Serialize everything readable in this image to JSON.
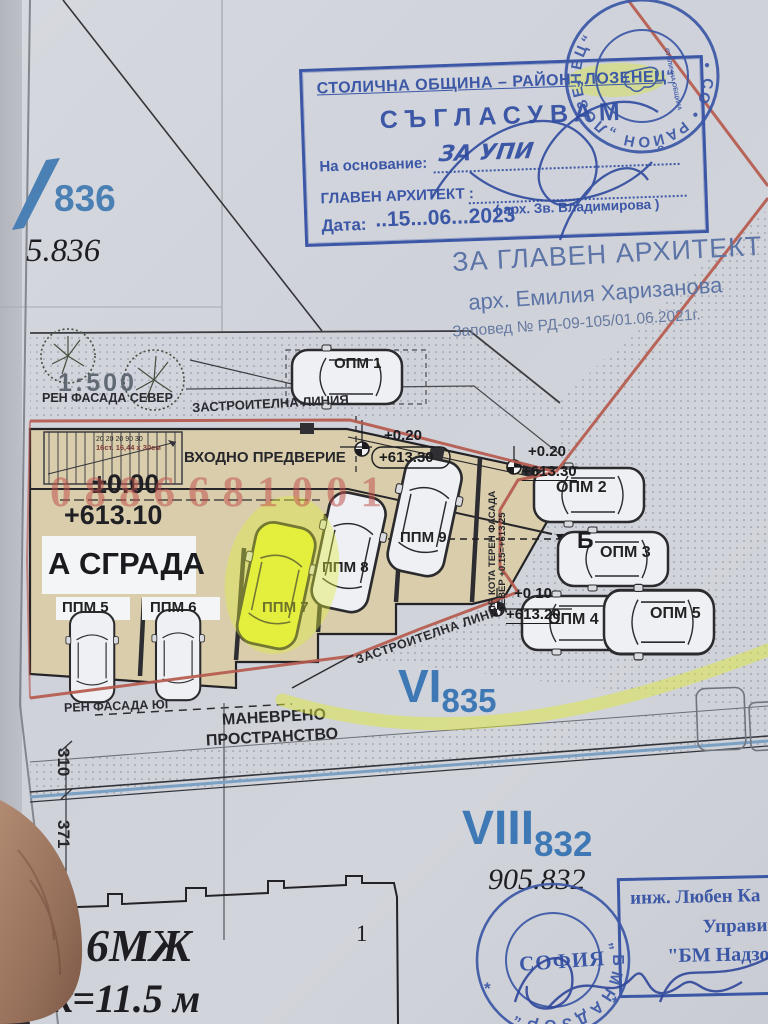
{
  "colors": {
    "stamp_blue": "#3b57a6",
    "plot_blue": "#3f79b5",
    "plan_red": "#b65a4e",
    "highlight_yellow": "#dde84a",
    "building_tan": "#d9cdab",
    "watermark_red": "#c04e48"
  },
  "left_margin": {
    "plot_label": "836",
    "plot_value": "5.836"
  },
  "approval_stamp": {
    "org": "СТОЛИЧНА ОБЩИНА – РАЙОН „ЛОЗЕНЕЦ“",
    "action": "СЪГЛАСУВАМ",
    "basis_label": "На основание:",
    "basis_value": "ЗА УПИ",
    "architect_label": "ГЛАВЕН АРХИТЕКТ :",
    "architect_name": "( арх. Зв. Владимирова )",
    "date_label": "Дата:",
    "date_value": "..15...06...2023"
  },
  "round_stamp_top": {
    "ring": "• СО • РАЙОН „ЛОЗЕНЕЦ“",
    "center": "СТОЛИЧНА ОБЩИНА"
  },
  "approval_note": {
    "title": "ЗА ГЛАВЕН АРХИТЕКТ",
    "name": "арх. Емилия Харизанова",
    "order": "Заповед № РД-09-105/01.06.2021г."
  },
  "watermark": "0886681001",
  "plan": {
    "scale": "1:500",
    "facade_north": "РЕН ФАСАДА СЕВЕР",
    "building_line": "ЗАСТРОИТЕЛНА ЛИНИЯ",
    "building_line_diag": "ЗАСТРОИТЕЛНА ЛИНИЯ",
    "entry_hall": "ВХОДНО ПРЕДВЕРИЕ",
    "stairs_dims": "20 20 20   90   30",
    "stairs_note": "16ст. 16,44 х 30см",
    "level_zero": "±0.00",
    "elev_zero": "+613.10",
    "level_020": "+0.20",
    "elev_020": "+613.30",
    "level_010": "+0.10",
    "elev_010": "+613.20",
    "building_label": "А СГРАДА",
    "marker_b": "Б",
    "kota_note_1": "ПР. КОТА ТЕРЕН ФАСАДА",
    "kota_note_2": "СЕВЕР +0.15=+613.25",
    "maneuver_1": "МАНЕВРЕНО",
    "maneuver_2": "ПРОСТРАНСТВО",
    "facade_south": "РЕН ФАСАДА ЮГ",
    "spots": [
      {
        "label": "ОПМ 1"
      },
      {
        "label": "ОПМ 2"
      },
      {
        "label": "ОПМ 3"
      },
      {
        "label": "ОПМ 4"
      },
      {
        "label": "ОПМ 5"
      },
      {
        "label": "ППМ 5"
      },
      {
        "label": "ППМ 6"
      },
      {
        "label": "ППМ 7"
      },
      {
        "label": "ППМ 8"
      },
      {
        "label": "ППМ 9"
      }
    ],
    "plot_vi": "VI",
    "plot_vi_num": "835",
    "dim_310": "310",
    "dim_371": "371",
    "plot_viii": "VIII",
    "plot_viii_num": "832",
    "plot_viii_value": "905.832",
    "lot_no": "1",
    "building_code": "6МЖ",
    "height_note": "к=11.5 м"
  },
  "supervision_stamp": {
    "ring": "„ Б М   Н А Д З О Р “",
    "center": "СОФИЯ",
    "star": "*"
  },
  "engineer_stamp": {
    "line1": "инж. Любен Ка",
    "line2": "Управи",
    "line3": "\"БМ Надзор"
  }
}
